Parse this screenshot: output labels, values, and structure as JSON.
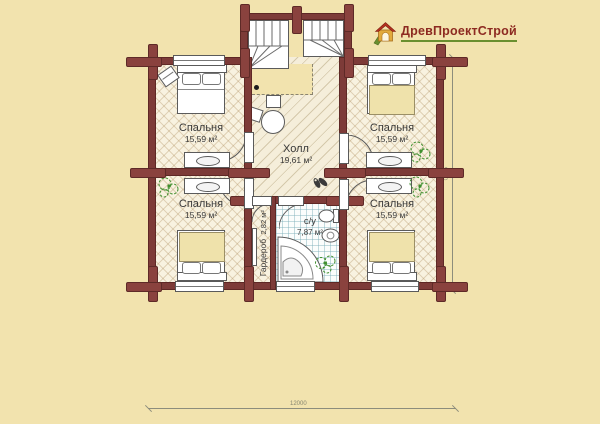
{
  "logo": {
    "text": "ДревПроектСтрой"
  },
  "rooms": {
    "bedroom_tl": {
      "name": "Спальня",
      "area": "15,59 м²"
    },
    "bedroom_tr": {
      "name": "Спальня",
      "area": "15,59 м²"
    },
    "bedroom_bl": {
      "name": "Спальня",
      "area": "15,59 м²"
    },
    "bedroom_br": {
      "name": "Спальня",
      "area": "15,59 м²"
    },
    "hall": {
      "name": "Холл",
      "area": "19,61 м²"
    },
    "bathroom": {
      "name": "с/у",
      "area": "7,87 м²"
    },
    "wardrobe": {
      "name": "Гардероб",
      "area": "2,82 м²"
    }
  },
  "dimensions": {
    "bottom": "12000",
    "right": "9000"
  },
  "colors": {
    "background": "#f2e3ae",
    "walls": "#7d3b38",
    "parquet_floor": "#f8f2e0",
    "hall_floor": "#f5eeda",
    "tile_floor": "#fbfdfc",
    "bed_blanket": "#efe2ab",
    "plant_green": "#3f8f2e",
    "logo_red": "#8d2a21",
    "logo_green": "#6a8f2f"
  }
}
